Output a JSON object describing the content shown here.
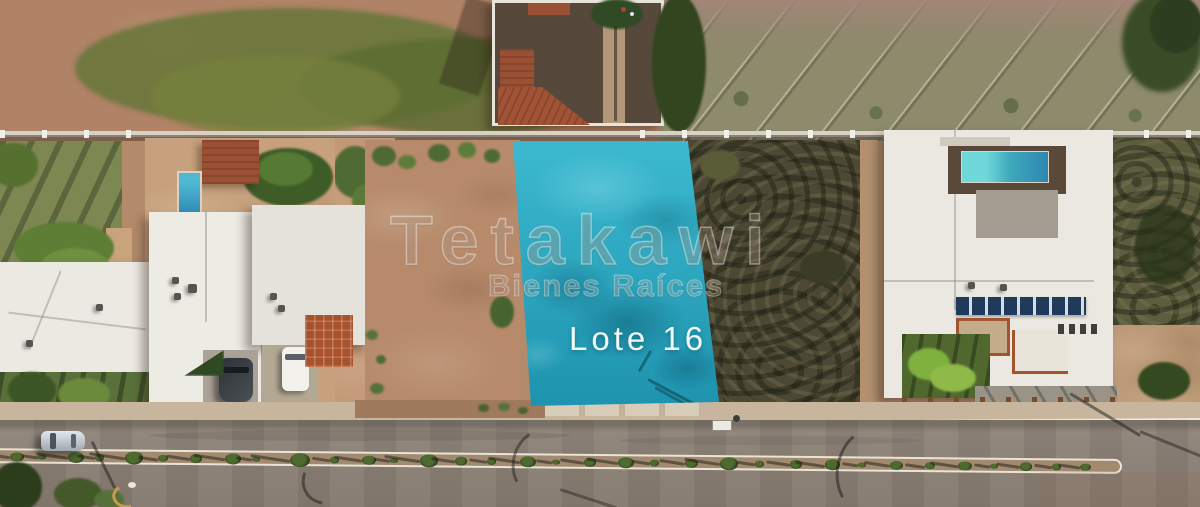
{
  "photo": {
    "type": "aerial-drone-photo",
    "lot_label": "Lote 16",
    "watermark_brand": "Tetakawi",
    "watermark_tagline": "Bienes Raíces"
  },
  "colors": {
    "lot_highlight": "#3cb9cf",
    "lot_highlight_deep": "#1e93af",
    "dirt": "#b38a6a",
    "dirt_dark": "#9a7256",
    "grass_field": "#6f7c44",
    "scrub_dark": "#4c4834",
    "road_asphalt": "#8d8278",
    "sidewalk": "#c7b59d",
    "curb_paint": "#ece7d9",
    "roof_white": "#ebe9e2",
    "roof_tile": "#9c5033",
    "pool_blue": "#2e86b0",
    "pool_aqua": "#6fd8da",
    "solar_panel": "#203a5c",
    "lot_label_text": "#f0fafb",
    "watermark_white": "#ffffff"
  }
}
